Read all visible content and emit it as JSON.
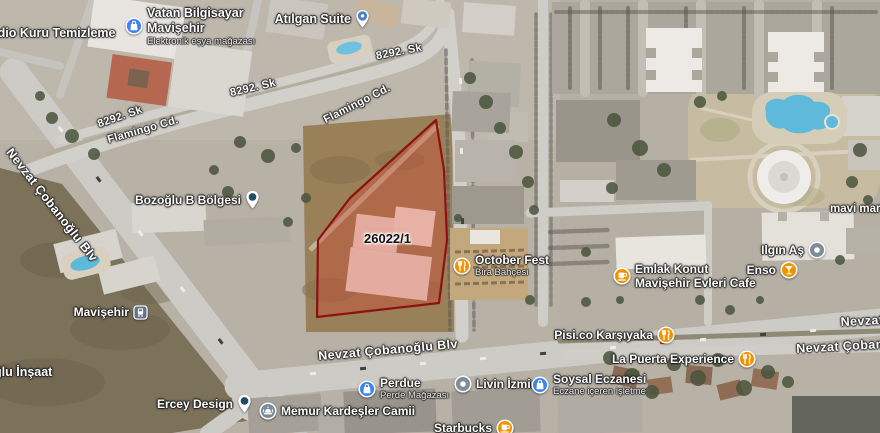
{
  "parcel": {
    "label": "26022/1"
  },
  "streets": [
    {
      "text": "8292. Sk"
    },
    {
      "text": "8292. Sk"
    },
    {
      "text": "8292. Sk"
    },
    {
      "text": "Flamingo Cd."
    },
    {
      "text": "Flamingo Cd."
    },
    {
      "text": "Nevzat Çobanoğlu Blv"
    },
    {
      "text": "Nevzat Çobanoğlu Blv"
    },
    {
      "text": "Nevzat"
    },
    {
      "text": "Nevzat Çobanoğ"
    }
  ],
  "pois": {
    "kuru_temizleme": {
      "name": "ndio Kuru Temizleme"
    },
    "vatan": {
      "line1": "Vatan Bilgisayar",
      "line2": "Mavişehir",
      "sub": "Elektronik eşya mağazası",
      "icon": "shopping-bag-icon"
    },
    "atilgan": {
      "name": "Atılgan Suite",
      "icon": "lodging-pin-icon"
    },
    "bozoglu": {
      "name": "Bozoğlu B Bölgesi",
      "icon": "place-pin-icon"
    },
    "october_fest": {
      "name": "October Fest",
      "sub": "Bira Bahçesi",
      "icon": "restaurant-icon"
    },
    "emlak": {
      "line1": "Emlak Konut",
      "line2": "Mavişehir Evleri Cafe",
      "icon": "cafe-icon"
    },
    "mavi_market": {
      "name": "mavi market"
    },
    "ilgin": {
      "name": "Ilgın Aş",
      "icon": "place-dot-icon"
    },
    "enso": {
      "name": "Enso",
      "icon": "bar-icon"
    },
    "pisi": {
      "name": "Pisi.co Karşıyaka",
      "icon": "restaurant-icon"
    },
    "la_puerta": {
      "name": "La Puerta Experience",
      "icon": "restaurant-icon"
    },
    "perdue": {
      "name": "Perdue",
      "sub": "Perde Mağazası",
      "icon": "shopping-bag-icon"
    },
    "livin": {
      "name": "Livin İzmir",
      "icon": "place-dot-icon"
    },
    "soysal": {
      "name": "Soysal Eczanesi",
      "sub": "Eczane içeren işletme",
      "icon": "shopping-bag-icon"
    },
    "starbucks": {
      "name": "Starbucks",
      "icon": "cafe-icon"
    },
    "mavisehir_station": {
      "name": "Mavişehir",
      "icon": "transit-icon"
    },
    "ercey": {
      "name": "Ercey Design",
      "icon": "place-pin-icon"
    },
    "memur": {
      "name": "Memur Kardeşler Camii",
      "icon": "mosque-icon"
    },
    "oglu_insaat": {
      "name": "ğlu İnşaat"
    }
  },
  "colors": {
    "parcel_fill": "#D9412F",
    "parcel_stroke": "#8E1111",
    "poi_orange": "#F09300",
    "poi_blue": "#3F83F0",
    "poi_slate": "#7D8E98",
    "pin_blue": "#4C7FC4",
    "pin_center": "#1F4E63",
    "transit_badge": "#64748C",
    "mosque_badge": "#7B8A9A",
    "pool": "#5FB9DA",
    "label_text": "#FFFFFF",
    "parcel_label_text": "#111111"
  }
}
